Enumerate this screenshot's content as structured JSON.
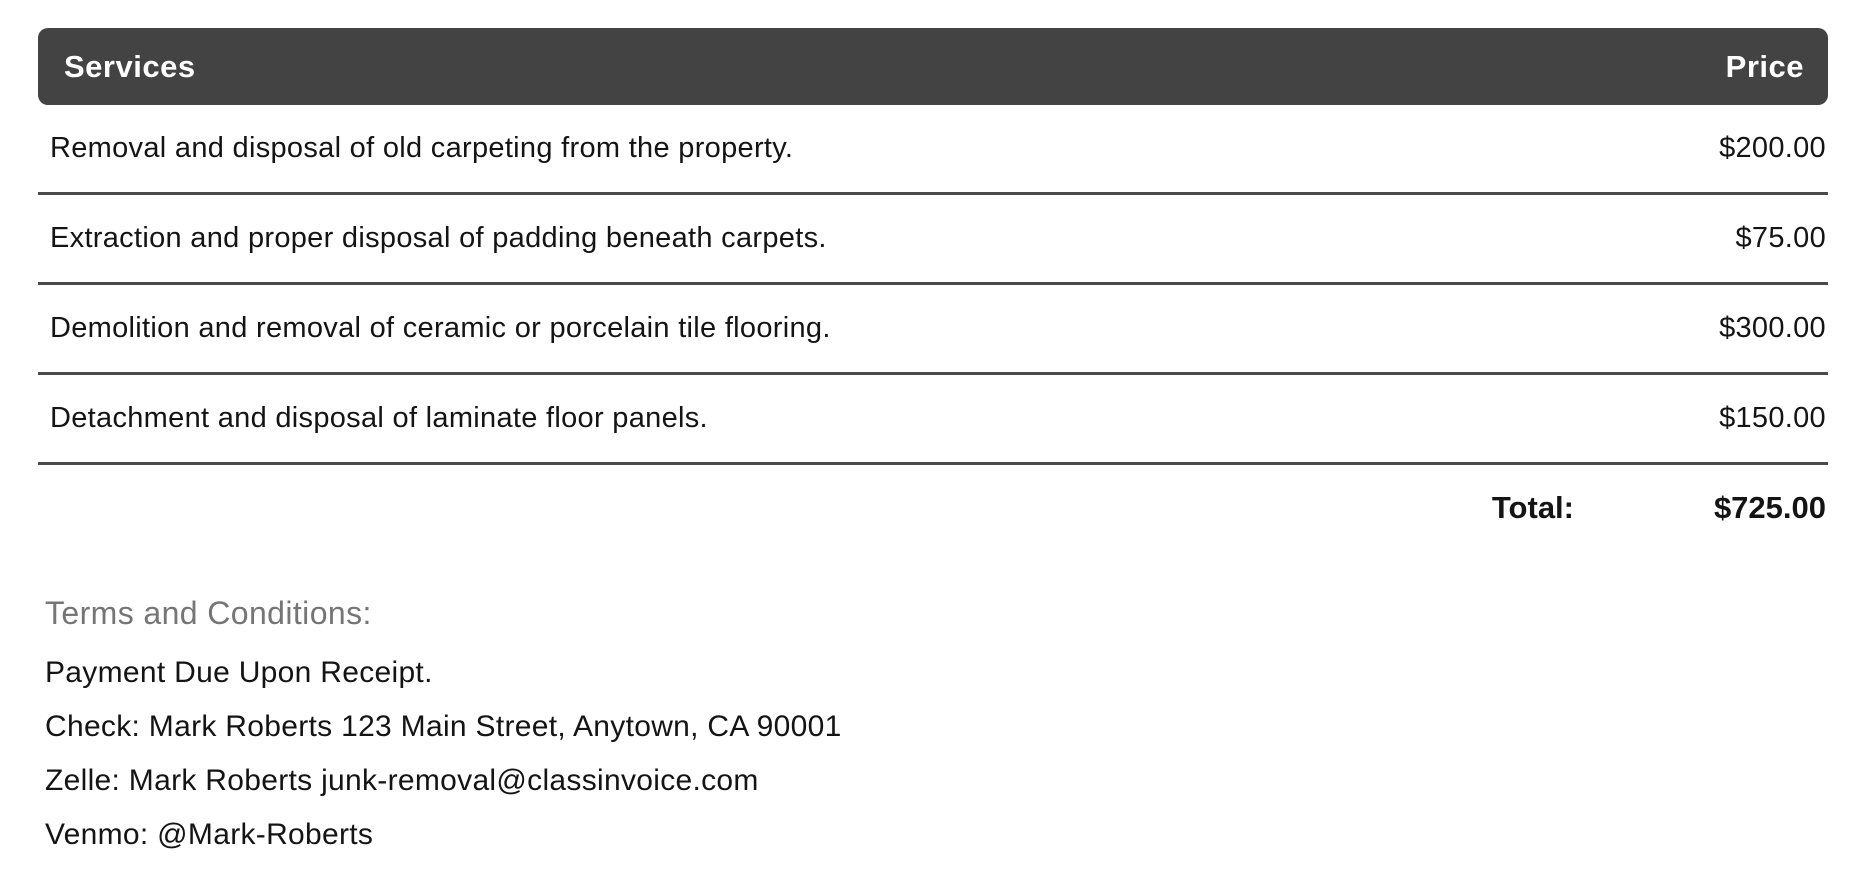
{
  "table": {
    "headers": {
      "service": "Services",
      "price": "Price"
    },
    "rows": [
      {
        "service": "Removal and disposal of old carpeting from the property.",
        "price": "$200.00"
      },
      {
        "service": "Extraction and proper disposal of padding beneath carpets.",
        "price": "$75.00"
      },
      {
        "service": "Demolition and removal of ceramic or porcelain tile flooring.",
        "price": "$300.00"
      },
      {
        "service": "Detachment and disposal of laminate floor panels.",
        "price": "$150.00"
      }
    ],
    "total_label": "Total:",
    "total_value": "$725.00"
  },
  "terms": {
    "heading": "Terms and Conditions:",
    "lines": [
      "Payment Due Upon Receipt.",
      "Check: Mark Roberts 123 Main Street, Anytown, CA 90001",
      "Zelle: Mark Roberts junk-removal@classinvoice.com",
      "Venmo: @Mark-Roberts"
    ]
  },
  "colors": {
    "header_background": "#434343",
    "header_text": "#ffffff",
    "body_text": "#141414",
    "divider": "#4a4a4a",
    "terms_heading_text": "#757575"
  }
}
